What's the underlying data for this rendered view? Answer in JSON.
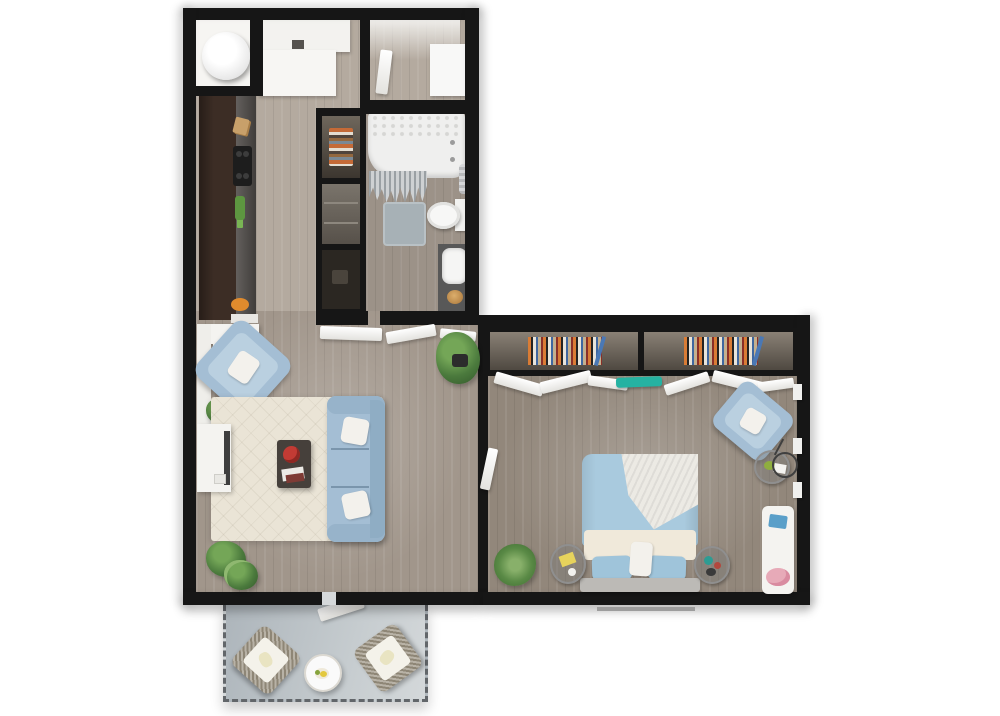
{
  "scene": {
    "kind": "3d-rendered-apartment-floor-plan",
    "view": "top-down"
  },
  "rooms": {
    "entry_hall": {
      "items": [
        "utility-closet",
        "water-heater-tank",
        "entry-cabinet",
        "shoe-bench"
      ]
    },
    "laundry_nook": {
      "items": [
        "washer",
        "open-door-leaf"
      ]
    },
    "kitchen": {
      "items": [
        "cabinet-run",
        "countertop",
        "cooktop",
        "cutting-boards",
        "green-bottles",
        "fruit-bowl"
      ]
    },
    "hall_closet": {
      "items": [
        "shelf-with-linens",
        "open-shelf",
        "storage-cell"
      ]
    },
    "bathroom": {
      "items": [
        "bathtub",
        "hex-tile-wall",
        "shower-curtain",
        "towel-warmer",
        "bath-mat",
        "toilet",
        "vanity",
        "sink",
        "gold-bowl"
      ]
    },
    "living_room": {
      "items": [
        "accent-armchair",
        "area-rug",
        "sofa",
        "throw-pillows",
        "coffee-table",
        "flower-vase",
        "books",
        "tv-console",
        "tv",
        "potted-plants",
        "wall-console"
      ]
    },
    "bedroom": {
      "items": [
        "bookshelf-left",
        "bookshelf-right",
        "hanging-clothes",
        "teal-folded-cloth",
        "queen-bed",
        "white-throw",
        "bed-pillows",
        "nightstand-left",
        "nightstand-right",
        "grass-plant",
        "reading-armchair",
        "floor-lamp",
        "glass-side-table",
        "white-bench",
        "pink-flowers",
        "window-sills",
        "door-leaf"
      ]
    },
    "balcony": {
      "items": [
        "railing-dashed-edge",
        "wicker-chair-left",
        "wicker-chair-right",
        "round-table",
        "open-door-leaf"
      ]
    }
  },
  "colors": {
    "wall": "#161616",
    "floor_hall": "#b4aa9f",
    "floor_living": "#a1968b",
    "floor_bedroom": "#92877b",
    "floor_bath": "#9c9288",
    "cabinet_brown": "#3c2d25",
    "counter_grey": "#4e4a47",
    "rug_cream": "#eae4d6",
    "upholstery_blue": "#a4bed4",
    "duvet_blue": "#a9cade",
    "sheet_cream": "#f0e9da",
    "pillow_white": "#f3f1ec",
    "headboard_grey": "#bcbab6",
    "balcony_floor": "#b7bec3",
    "wicker_tan": "#9a9180",
    "cushion_white": "#f4f2ea",
    "bookshelf_bg": "#5d564d",
    "teal_accent": "#25b2a2",
    "plant_green": "#4b7a3d",
    "tub_white": "#efefee",
    "mat_grey": "#a7b1b6",
    "vanity_grey": "#585858",
    "gold_accent": "#c08f4f",
    "tv_dark": "#3e3e3e",
    "flowers_red": "#c23b34",
    "item_yellow": "#e7d35c",
    "item_blue": "#5a9fc9",
    "item_pink": "#e7aab8",
    "fruit_orange": "#e08b2d",
    "threshold_grey": "#d5d8da",
    "step_line_grey": "#9c9c9c"
  }
}
